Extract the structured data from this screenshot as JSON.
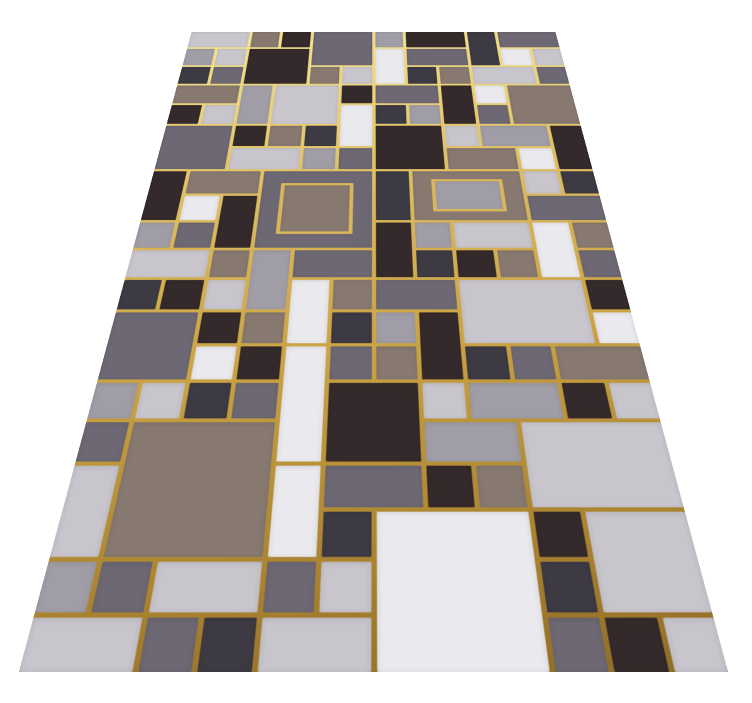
{
  "image": {
    "description": "Geometric patchwork area rug viewed in floor perspective on a plain white background; rectangular color blocks separated by metallic gold lines.",
    "background_color": "#ffffff"
  },
  "rug": {
    "gold_line_gradient": [
      "#f3e594",
      "#d9b65a",
      "#a8812f"
    ],
    "palette": {
      "D": "#352a2b",
      "C": "#3d3a43",
      "G": "#6d6873",
      "M": "#a09da6",
      "L": "#c8c5cc",
      "W": "#eae9ed",
      "T": "#877970"
    },
    "grid": {
      "columns": 12,
      "rows": 20,
      "line_gap_px": 4
    },
    "blocks": [
      [
        1,
        1,
        2,
        1,
        "L"
      ],
      [
        3,
        1,
        1,
        1,
        "T"
      ],
      [
        4,
        1,
        1,
        1,
        "D"
      ],
      [
        5,
        1,
        2,
        2,
        "G"
      ],
      [
        7,
        1,
        1,
        1,
        "M"
      ],
      [
        8,
        1,
        2,
        1,
        "D"
      ],
      [
        10,
        1,
        1,
        2,
        "C"
      ],
      [
        11,
        1,
        2,
        1,
        "G"
      ],
      [
        1,
        2,
        1,
        1,
        "M"
      ],
      [
        2,
        2,
        1,
        1,
        "L"
      ],
      [
        3,
        2,
        2,
        2,
        "D"
      ],
      [
        7,
        2,
        1,
        2,
        "W"
      ],
      [
        8,
        2,
        2,
        1,
        "G"
      ],
      [
        11,
        2,
        1,
        1,
        "W"
      ],
      [
        12,
        2,
        1,
        1,
        "L"
      ],
      [
        1,
        3,
        1,
        1,
        "C"
      ],
      [
        2,
        3,
        1,
        1,
        "G"
      ],
      [
        5,
        3,
        1,
        1,
        "T"
      ],
      [
        6,
        3,
        1,
        1,
        "L"
      ],
      [
        8,
        3,
        1,
        1,
        "C"
      ],
      [
        9,
        3,
        1,
        1,
        "T"
      ],
      [
        10,
        3,
        2,
        1,
        "L"
      ],
      [
        12,
        3,
        1,
        1,
        "G"
      ],
      [
        1,
        4,
        2,
        1,
        "T"
      ],
      [
        3,
        4,
        1,
        2,
        "M"
      ],
      [
        4,
        4,
        2,
        2,
        "L"
      ],
      [
        6,
        4,
        1,
        1,
        "D"
      ],
      [
        7,
        4,
        2,
        1,
        "G"
      ],
      [
        9,
        4,
        1,
        2,
        "D"
      ],
      [
        10,
        4,
        1,
        1,
        "W"
      ],
      [
        11,
        4,
        2,
        2,
        "T"
      ],
      [
        1,
        5,
        1,
        1,
        "D"
      ],
      [
        2,
        5,
        1,
        1,
        "L"
      ],
      [
        6,
        5,
        1,
        2,
        "W"
      ],
      [
        7,
        5,
        1,
        1,
        "C"
      ],
      [
        8,
        5,
        1,
        1,
        "M"
      ],
      [
        10,
        5,
        1,
        1,
        "G"
      ],
      [
        1,
        6,
        2,
        2,
        "G"
      ],
      [
        3,
        6,
        1,
        1,
        "D"
      ],
      [
        4,
        6,
        1,
        1,
        "T"
      ],
      [
        5,
        6,
        1,
        1,
        "C"
      ],
      [
        7,
        6,
        2,
        2,
        "D"
      ],
      [
        9,
        6,
        1,
        1,
        "L"
      ],
      [
        10,
        6,
        2,
        1,
        "M"
      ],
      [
        12,
        6,
        1,
        2,
        "D"
      ],
      [
        3,
        7,
        2,
        1,
        "L"
      ],
      [
        5,
        7,
        1,
        1,
        "M"
      ],
      [
        6,
        7,
        1,
        1,
        "G"
      ],
      [
        9,
        7,
        2,
        1,
        "T"
      ],
      [
        11,
        7,
        1,
        1,
        "W"
      ],
      [
        1,
        8,
        1,
        2,
        "D"
      ],
      [
        2,
        8,
        2,
        1,
        "T"
      ],
      [
        4,
        8,
        3,
        3,
        "G",
        "T"
      ],
      [
        7,
        8,
        1,
        2,
        "C"
      ],
      [
        8,
        8,
        3,
        2,
        "T",
        "M"
      ],
      [
        11,
        8,
        1,
        1,
        "L"
      ],
      [
        12,
        8,
        1,
        1,
        "C"
      ],
      [
        2,
        9,
        1,
        1,
        "W"
      ],
      [
        3,
        9,
        1,
        2,
        "D"
      ],
      [
        11,
        9,
        2,
        1,
        "G"
      ],
      [
        1,
        10,
        1,
        1,
        "M"
      ],
      [
        2,
        10,
        1,
        1,
        "G"
      ],
      [
        7,
        10,
        1,
        2,
        "D"
      ],
      [
        8,
        10,
        1,
        1,
        "M"
      ],
      [
        9,
        10,
        2,
        1,
        "L"
      ],
      [
        11,
        10,
        1,
        2,
        "W"
      ],
      [
        12,
        10,
        1,
        1,
        "T"
      ],
      [
        1,
        11,
        2,
        1,
        "L"
      ],
      [
        3,
        11,
        1,
        1,
        "T"
      ],
      [
        4,
        11,
        1,
        2,
        "M"
      ],
      [
        5,
        11,
        2,
        1,
        "G"
      ],
      [
        8,
        11,
        1,
        1,
        "C"
      ],
      [
        9,
        11,
        1,
        1,
        "D"
      ],
      [
        10,
        11,
        1,
        1,
        "T"
      ],
      [
        12,
        11,
        1,
        1,
        "G"
      ],
      [
        1,
        12,
        1,
        1,
        "C"
      ],
      [
        2,
        12,
        1,
        1,
        "D"
      ],
      [
        3,
        12,
        1,
        1,
        "L"
      ],
      [
        5,
        12,
        1,
        2,
        "W"
      ],
      [
        6,
        12,
        1,
        1,
        "T"
      ],
      [
        7,
        12,
        2,
        1,
        "G"
      ],
      [
        9,
        12,
        3,
        2,
        "L"
      ],
      [
        12,
        12,
        1,
        1,
        "D"
      ],
      [
        1,
        13,
        2,
        2,
        "G"
      ],
      [
        3,
        13,
        1,
        1,
        "D"
      ],
      [
        4,
        13,
        1,
        1,
        "T"
      ],
      [
        6,
        13,
        1,
        1,
        "C"
      ],
      [
        7,
        13,
        1,
        1,
        "M"
      ],
      [
        8,
        13,
        1,
        2,
        "D"
      ],
      [
        12,
        13,
        1,
        1,
        "W"
      ],
      [
        3,
        14,
        1,
        1,
        "W"
      ],
      [
        4,
        14,
        1,
        1,
        "D"
      ],
      [
        5,
        14,
        1,
        3,
        "W"
      ],
      [
        6,
        14,
        1,
        1,
        "G"
      ],
      [
        7,
        14,
        1,
        1,
        "T"
      ],
      [
        9,
        14,
        1,
        1,
        "C"
      ],
      [
        10,
        14,
        1,
        1,
        "G"
      ],
      [
        11,
        14,
        2,
        1,
        "T"
      ],
      [
        1,
        15,
        1,
        1,
        "M"
      ],
      [
        2,
        15,
        1,
        1,
        "L"
      ],
      [
        3,
        15,
        1,
        1,
        "C"
      ],
      [
        4,
        15,
        1,
        1,
        "G"
      ],
      [
        6,
        15,
        2,
        2,
        "D"
      ],
      [
        8,
        15,
        1,
        1,
        "L"
      ],
      [
        9,
        15,
        2,
        1,
        "M"
      ],
      [
        11,
        15,
        1,
        1,
        "D"
      ],
      [
        12,
        15,
        1,
        1,
        "L"
      ],
      [
        1,
        16,
        1,
        1,
        "G"
      ],
      [
        2,
        16,
        3,
        3,
        "T"
      ],
      [
        8,
        16,
        2,
        1,
        "M"
      ],
      [
        10,
        16,
        3,
        2,
        "L"
      ],
      [
        1,
        17,
        1,
        2,
        "L"
      ],
      [
        5,
        17,
        1,
        2,
        "W"
      ],
      [
        6,
        17,
        2,
        1,
        "G"
      ],
      [
        8,
        17,
        1,
        1,
        "D"
      ],
      [
        9,
        17,
        1,
        1,
        "T"
      ],
      [
        6,
        18,
        1,
        1,
        "C"
      ],
      [
        7,
        18,
        3,
        3,
        "W"
      ],
      [
        10,
        18,
        1,
        1,
        "D"
      ],
      [
        11,
        18,
        2,
        2,
        "L"
      ],
      [
        1,
        19,
        1,
        1,
        "M"
      ],
      [
        2,
        19,
        1,
        1,
        "G"
      ],
      [
        3,
        19,
        2,
        1,
        "L"
      ],
      [
        5,
        19,
        1,
        1,
        "G"
      ],
      [
        6,
        19,
        1,
        1,
        "L"
      ],
      [
        10,
        19,
        1,
        1,
        "C"
      ],
      [
        1,
        20,
        2,
        1,
        "L"
      ],
      [
        3,
        20,
        1,
        1,
        "G"
      ],
      [
        4,
        20,
        1,
        1,
        "C"
      ],
      [
        5,
        20,
        2,
        1,
        "L"
      ],
      [
        10,
        20,
        1,
        1,
        "G"
      ],
      [
        11,
        20,
        1,
        1,
        "D"
      ],
      [
        12,
        20,
        1,
        1,
        "L"
      ]
    ]
  }
}
